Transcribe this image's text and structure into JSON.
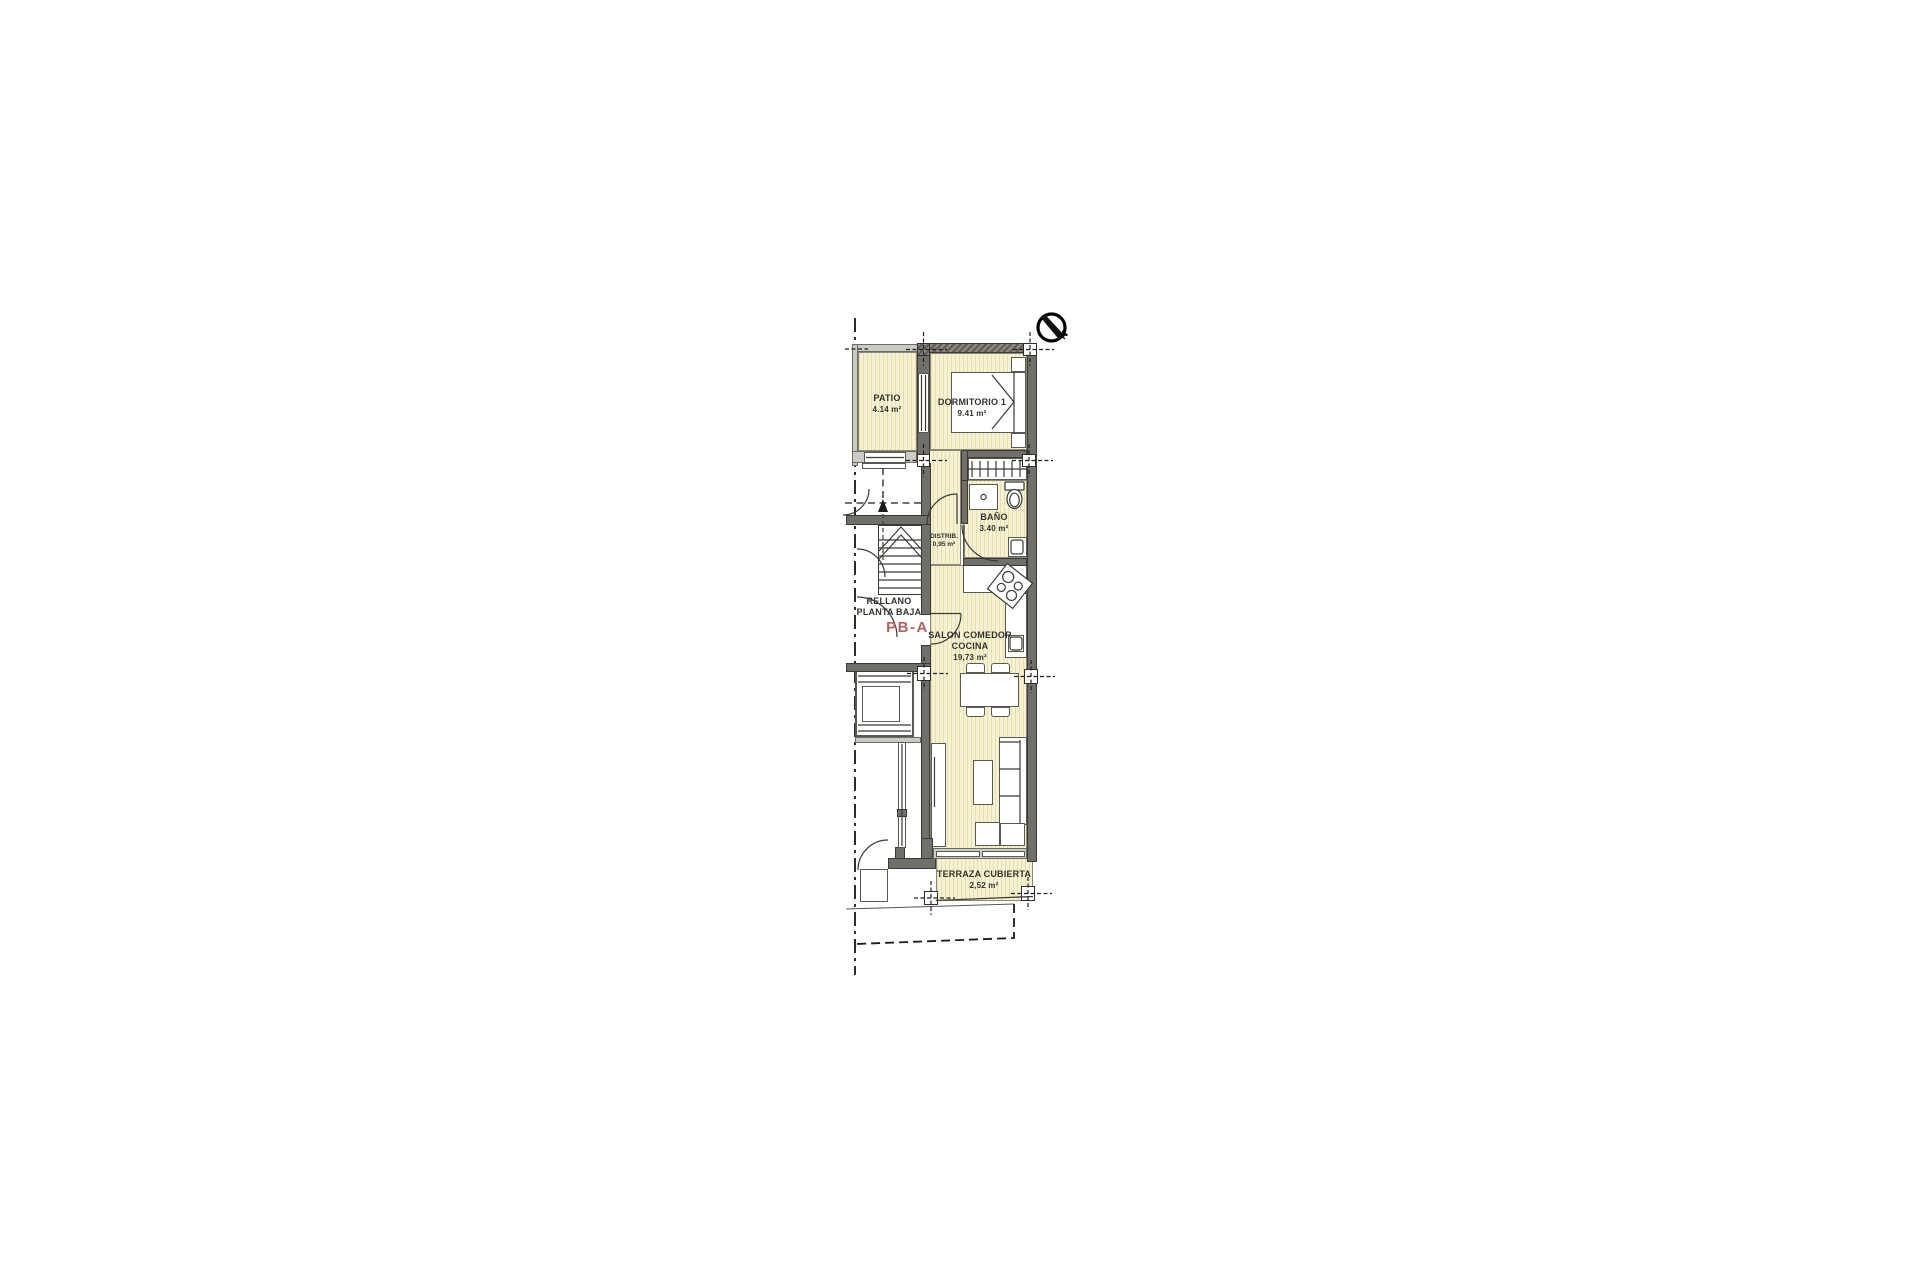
{
  "plan": {
    "compass": {
      "label": "N"
    },
    "rooms": {
      "patio": {
        "name": "PATIO",
        "area": "4.14 m²"
      },
      "dormitorio": {
        "name": "DORMITORIO 1",
        "area": "9.41 m²"
      },
      "bano": {
        "name": "BAÑO",
        "area": "3.40 m²"
      },
      "distrib": {
        "name": "DISTRIB.",
        "area": "0,95 m²"
      },
      "salon": {
        "name1": "SALON COMEDOR",
        "name2": "COCINA",
        "area": "19,73 m²"
      },
      "terraza": {
        "name": "TERRAZA CUBIERTA",
        "area": "2,52 m²"
      },
      "rellano": {
        "line1": "RELLANO",
        "line2": "PLANTA BAJA",
        "code": "PB-A"
      }
    },
    "colors": {
      "floor": "#f7f1d4",
      "wall": "#706f69",
      "accent_red": "#b4625e"
    }
  }
}
